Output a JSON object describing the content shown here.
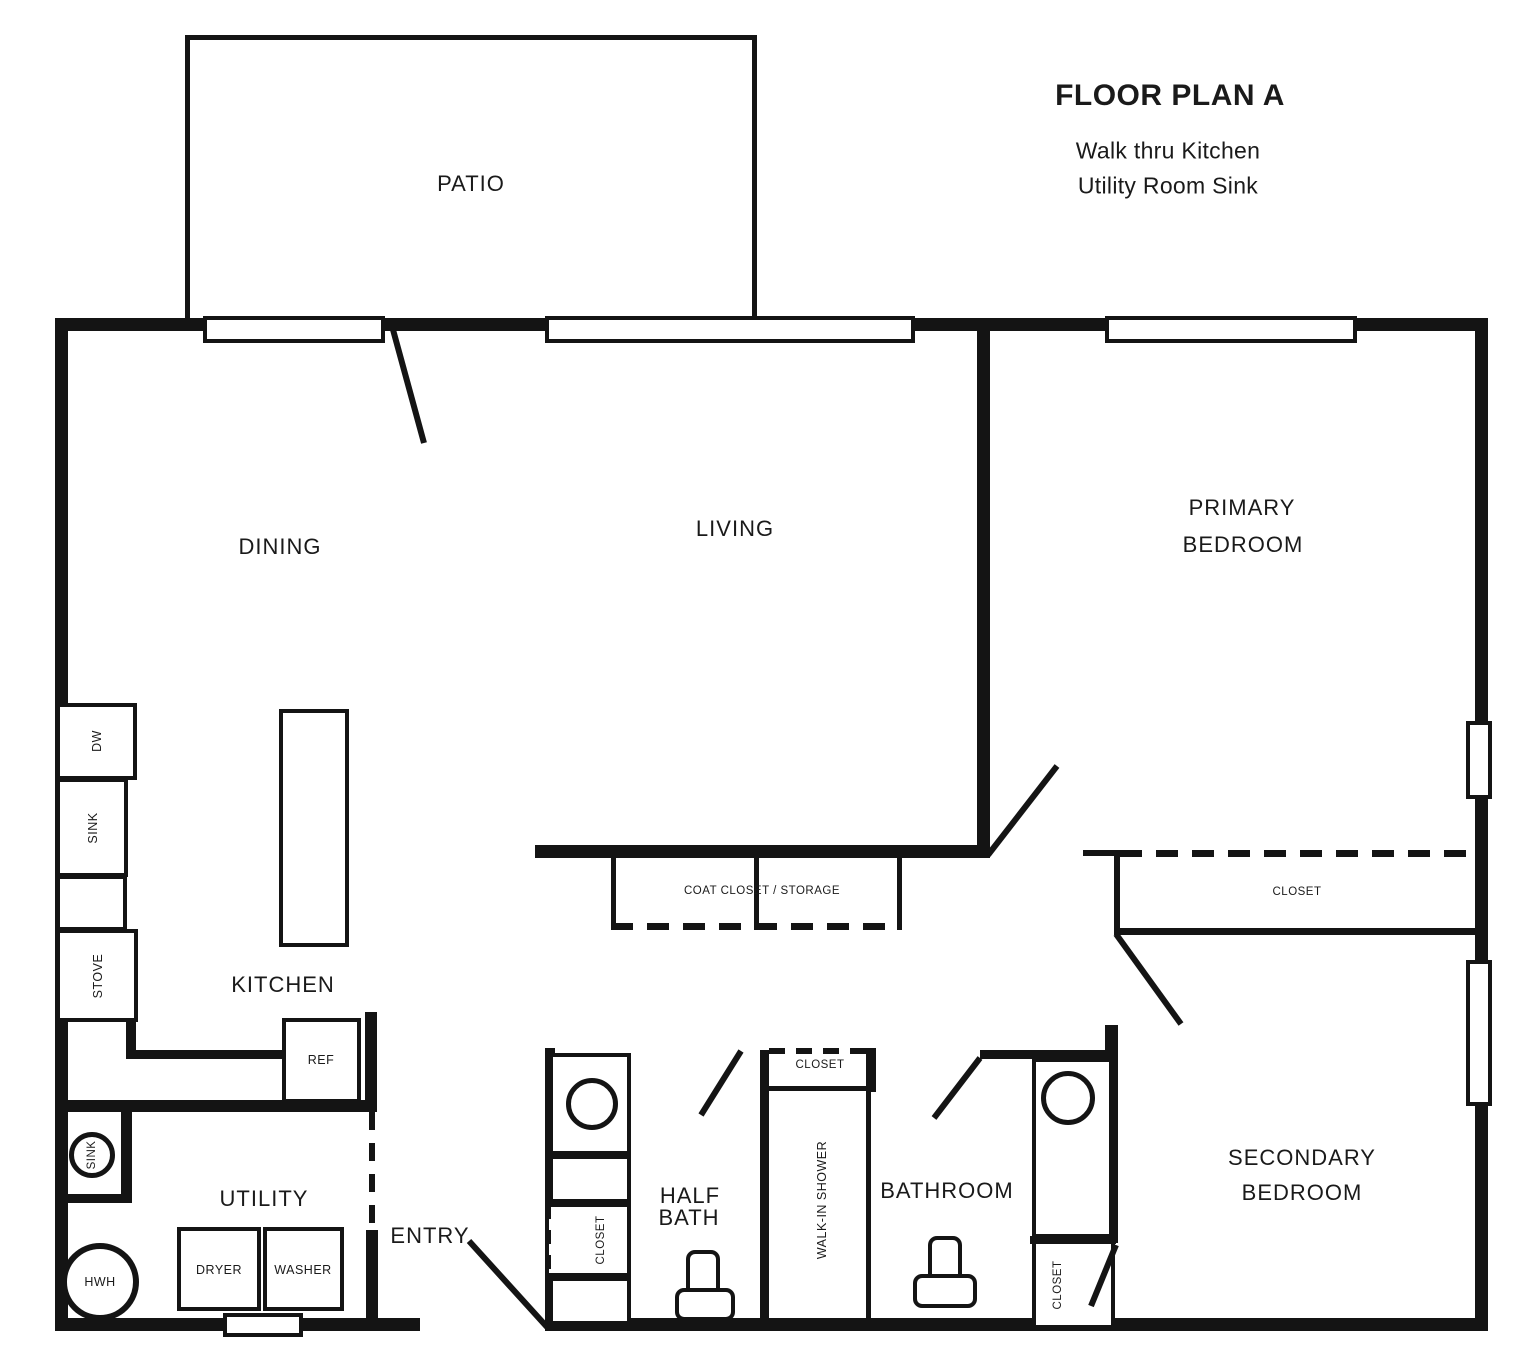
{
  "title": {
    "main": "FLOOR PLAN A",
    "subtitle_line1": "Walk thru Kitchen",
    "subtitle_line2": "Utility Room Sink"
  },
  "rooms": {
    "patio": "PATIO",
    "dining": "DINING",
    "living": "LIVING",
    "kitchen": "KITCHEN",
    "utility": "UTILITY",
    "entry": "ENTRY",
    "half_bath_line1": "HALF",
    "half_bath_line2": "BATH",
    "bathroom": "BATHROOM",
    "primary_bedroom_line1": "PRIMARY",
    "primary_bedroom_line2": "BEDROOM",
    "secondary_bedroom_line1": "SECONDARY",
    "secondary_bedroom_line2": "BEDROOM"
  },
  "fixtures": {
    "dishwasher": "DW",
    "kitchen_sink": "SINK",
    "stove": "STOVE",
    "refrigerator": "REF",
    "utility_sink": "SINK",
    "water_heater": "HWH",
    "dryer": "DRYER",
    "washer": "WASHER",
    "walk_in_shower": "WALK-IN SHOWER",
    "coat_closet": "COAT CLOSET / STORAGE",
    "secondary_bedroom_closet": "CLOSET",
    "shower_closet": "CLOSET",
    "half_bath_closet": "CLOSET",
    "bathroom_closet": "CLOSET"
  },
  "colors": {
    "ink": "#141414",
    "paper": "#ffffff"
  }
}
